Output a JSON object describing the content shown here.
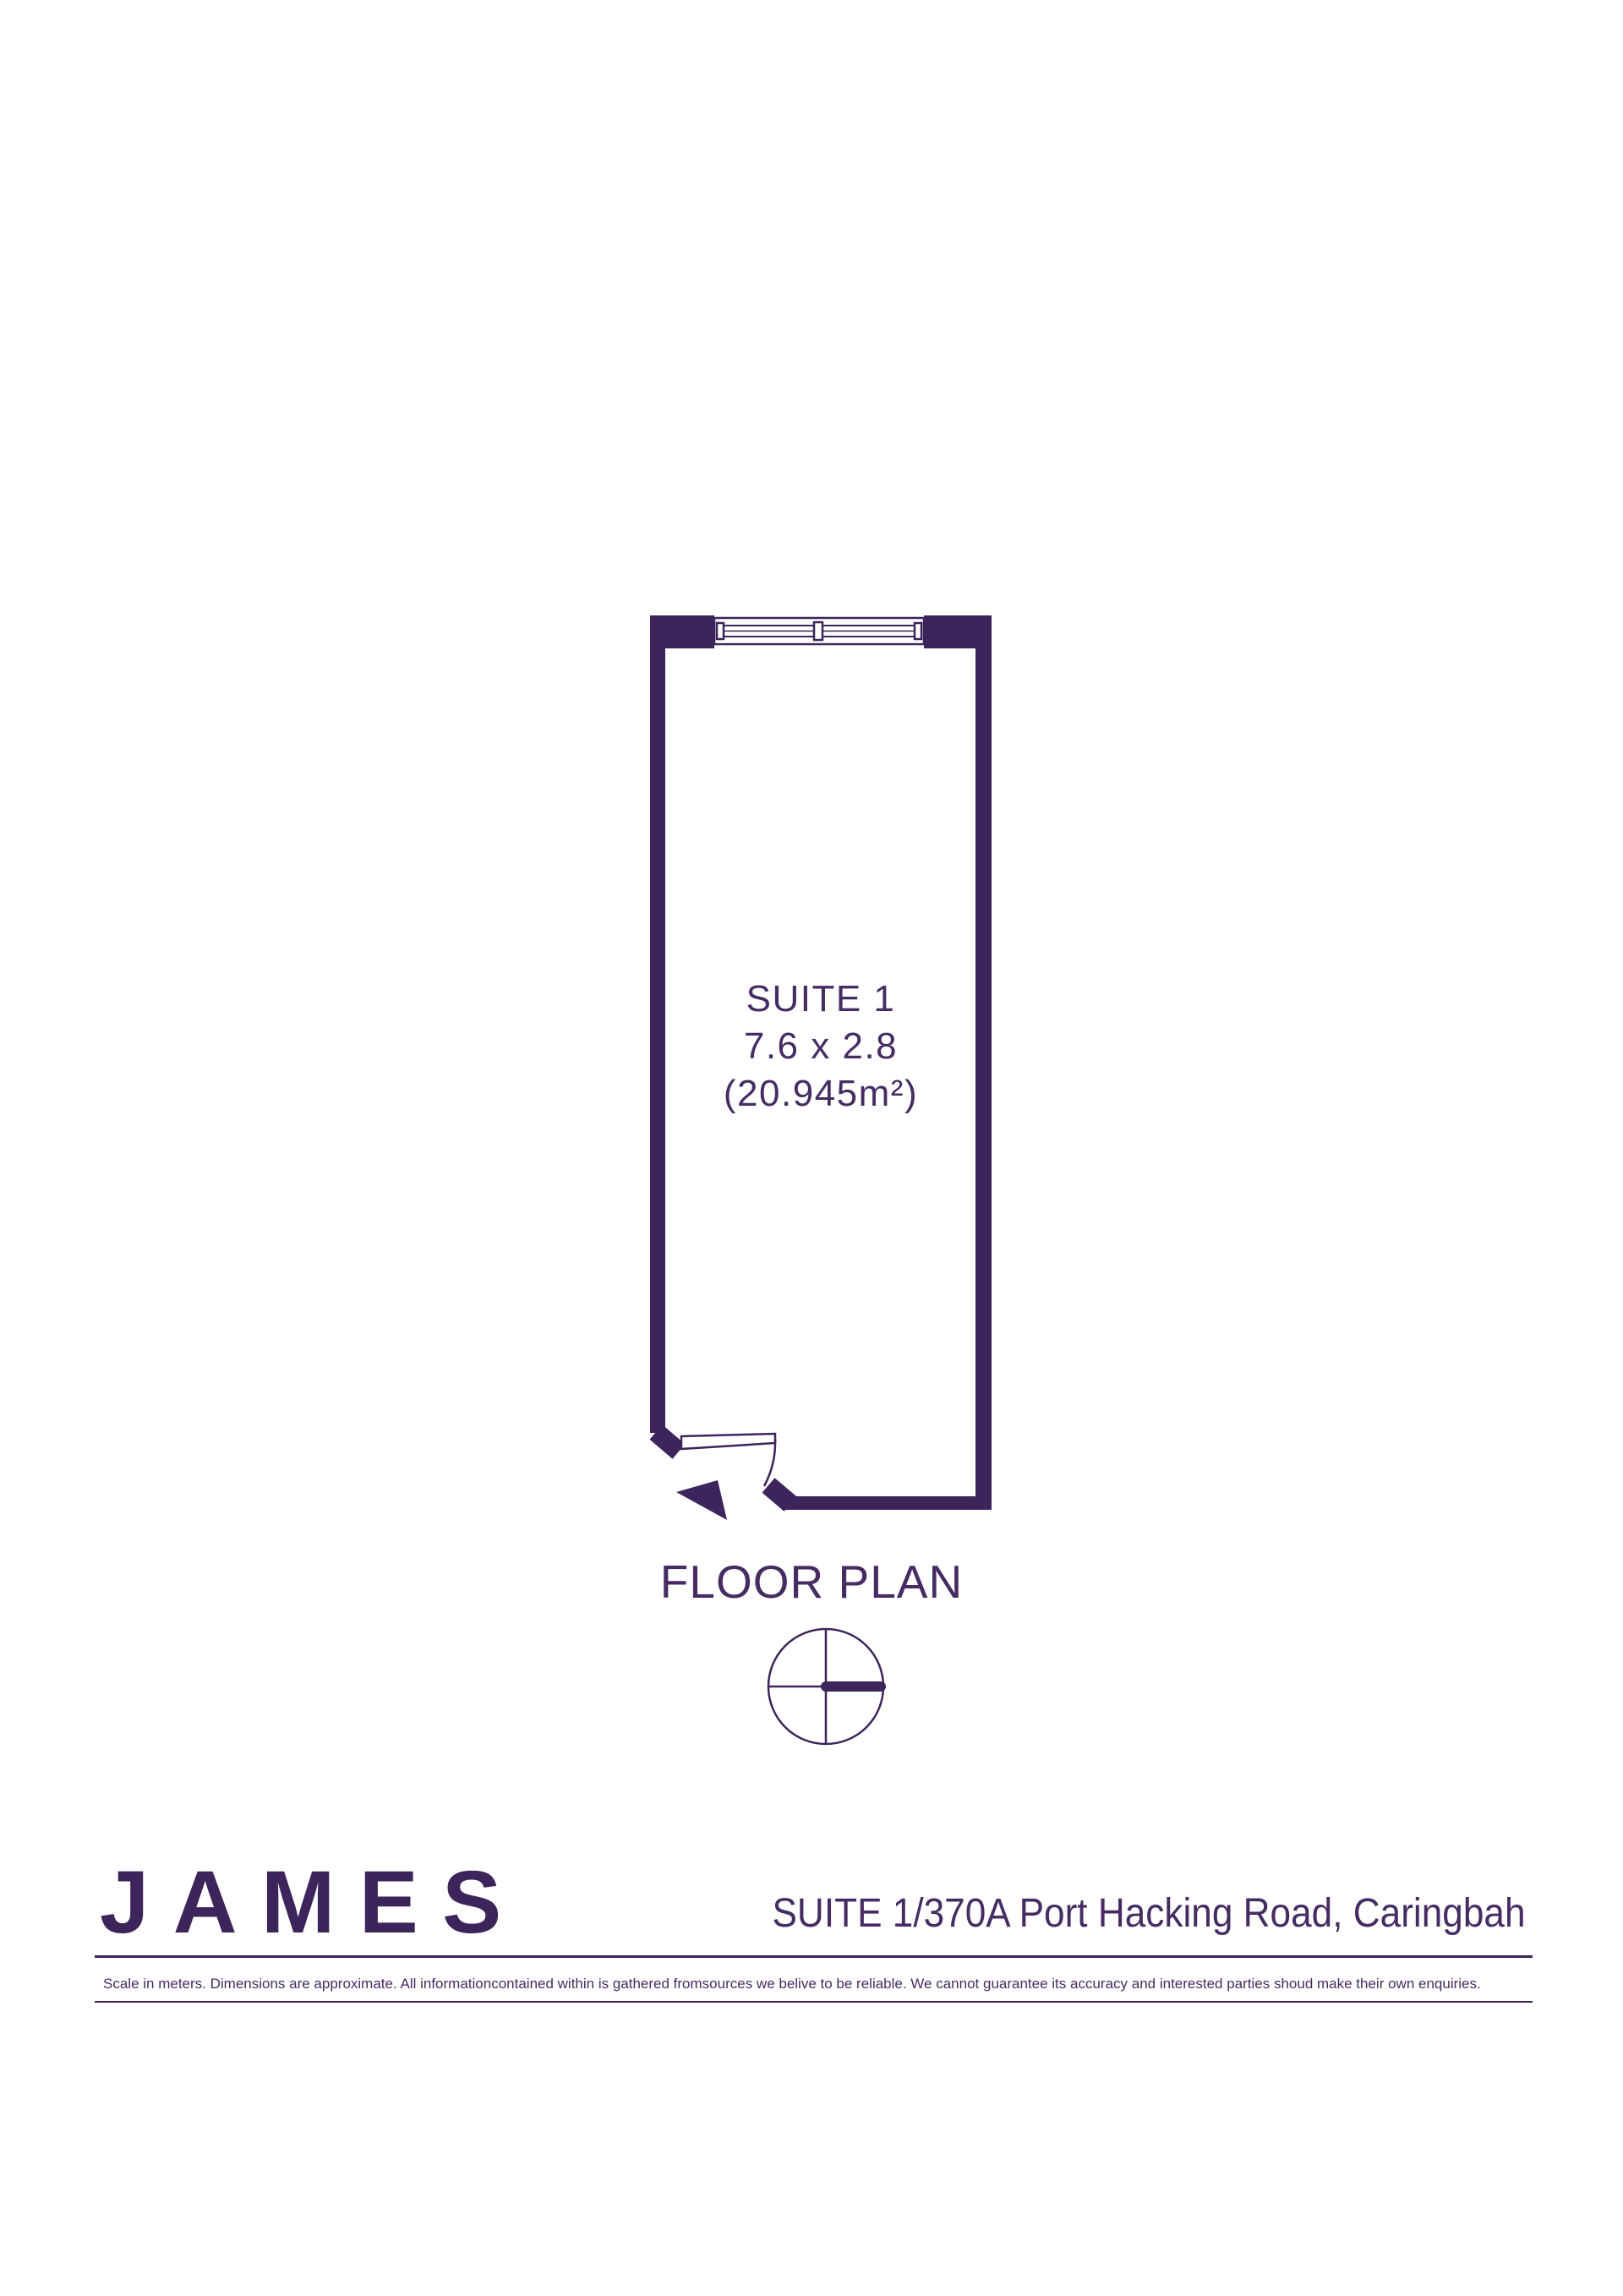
{
  "colors": {
    "wall_purple": "#3d245a",
    "text_purple": "#462c62",
    "background": "#ffffff"
  },
  "plan": {
    "room": {
      "name": "SUITE 1",
      "dimensions": "7.6 x 2.8",
      "area": "(20.945m²)"
    },
    "caption": "FLOOR PLAN",
    "icons": [
      "window-symbol",
      "door-swing-icon",
      "entry-arrow-icon",
      "compass-icon"
    ]
  },
  "footer": {
    "brand": "JAMES",
    "address": "SUITE 1/370A Port Hacking Road, Caringbah",
    "disclaimer": "Scale in meters. Dimensions are approximate. All informationcontained within is gathered fromsources we belive to be reliable. We cannot guarantee its accuracy and interested parties shoud make their own enquiries."
  }
}
